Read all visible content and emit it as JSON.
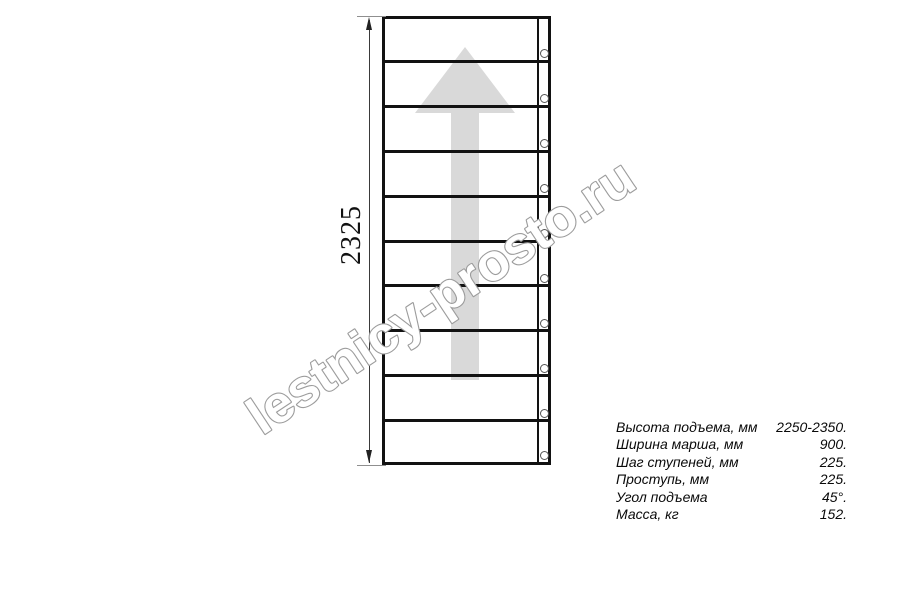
{
  "drawing": {
    "dimension_label": "2325",
    "watermark": "lestnicy-prosto.ru",
    "treads_count": 10,
    "balusters_count": 10,
    "colors": {
      "line": "#121212",
      "arrow_fill": "#d9d9d9",
      "watermark_outline": "#9c9c9c",
      "dimension_line": "#3a3a3a"
    }
  },
  "specs": {
    "rows": [
      {
        "label": "Высота подъема, мм",
        "value": "2250-2350."
      },
      {
        "label": "Ширина марша, мм",
        "value": "900."
      },
      {
        "label": "Шаг ступеней, мм",
        "value": "225."
      },
      {
        "label": "Проступь, мм",
        "value": "225."
      },
      {
        "label": "Угол подъема",
        "value": "45°."
      },
      {
        "label": "Масса, кг",
        "value": "152."
      }
    ]
  }
}
